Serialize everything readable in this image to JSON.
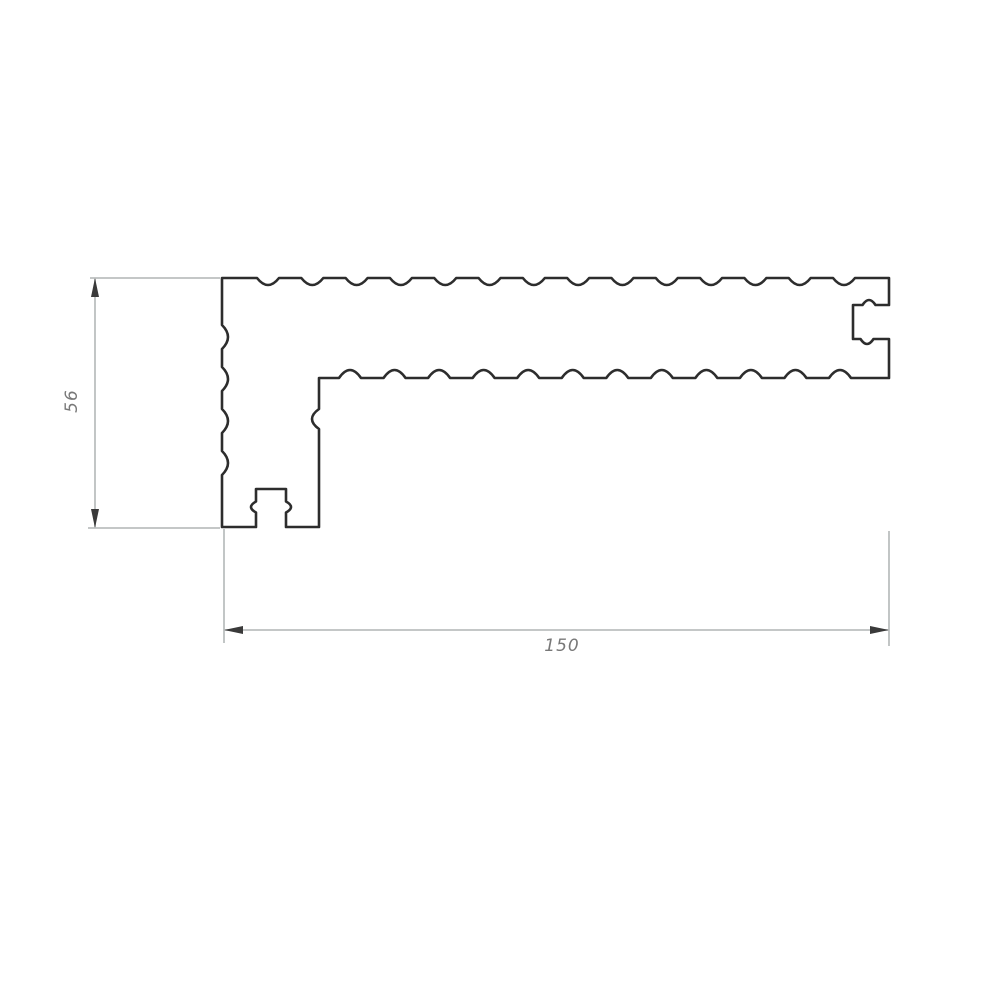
{
  "diagram": {
    "title": "L-shaped grooved profile cross-section technical drawing",
    "labels": {
      "height_dim": "56",
      "width_dim": "150"
    },
    "colors": {
      "background": "#ffffff",
      "outline": "#2d2d2d",
      "outline_shadow": "#8a8a8a",
      "dimension_line": "#bcbfbf",
      "arrow": "#3a3a3a",
      "label": "#787878"
    }
  }
}
